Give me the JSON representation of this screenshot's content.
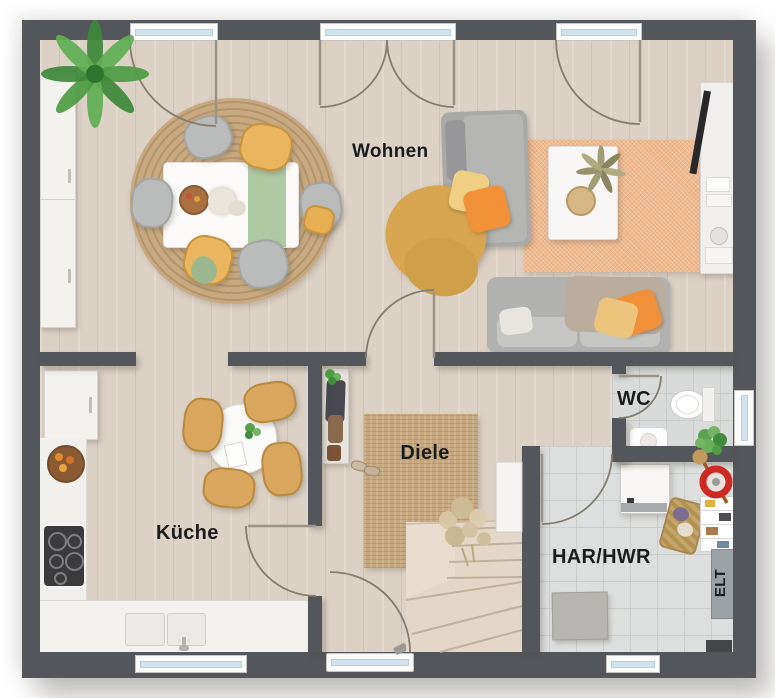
{
  "plan": {
    "type": "residential-floor-plan-ground-floor",
    "floor_labels": {
      "wohnen": "Wohnen",
      "kueche": "Küche",
      "diele": "Diele",
      "wc": "WC",
      "har_hwr": "HAR/HWR",
      "elt": "ELT"
    },
    "colors": {
      "wall": "#53575b",
      "wood_floor": "#dbd1c5",
      "tile_floor": "#d9dbda",
      "jute_rug": "#c6a87f",
      "orange_rug": "#eeb98e",
      "sofa_gray": "#abaaa8",
      "accent_orange": "#f09138",
      "accent_yellow": "#ecc47c",
      "accent_mustard": "#d8a550",
      "accent_green": "#aecaa3",
      "wood_chair": "#d9a75d",
      "window_glass": "#cfe3ee",
      "label_text": "#1b1c1e"
    }
  }
}
